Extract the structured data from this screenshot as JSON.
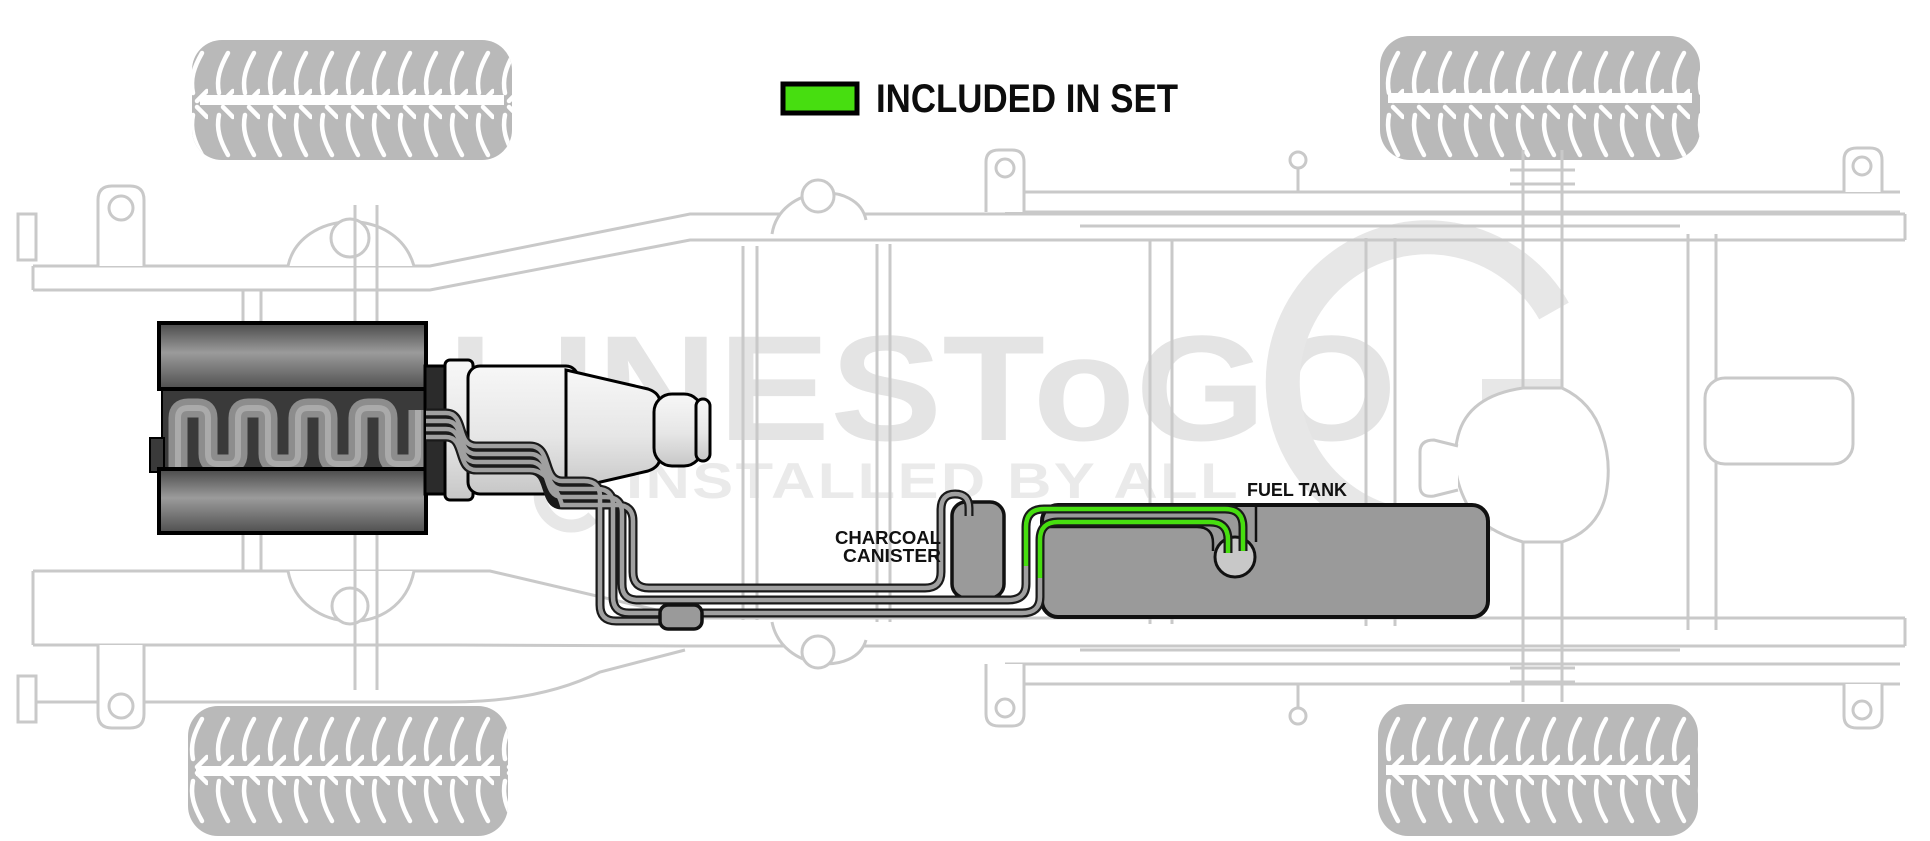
{
  "legend": {
    "label": "INCLUDED IN SET",
    "swatch_color": "#47de10"
  },
  "annotations": {
    "charcoal_canister_line1": "CHARCOAL",
    "charcoal_canister_line2": "CANISTER",
    "fuel_tank": "FUEL TANK"
  },
  "watermark": {
    "brand": "LINESToGO",
    "tagline": "INSTALLED BY ALL"
  },
  "colors": {
    "included_green": "#47de10",
    "line_gray": "#a0a0a0",
    "line_outline": "#1a1a1a",
    "part_gray": "#9a9a9a",
    "frame_gray": "#c9c9c9",
    "watermark_gray": "#e4e4e4"
  }
}
